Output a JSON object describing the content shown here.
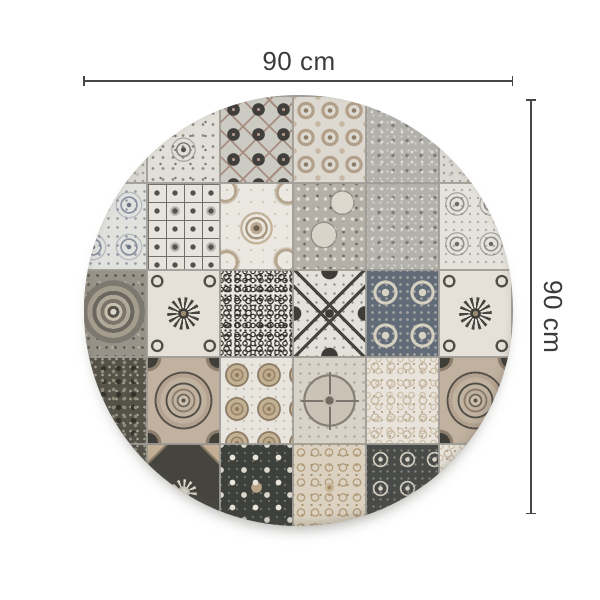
{
  "diagram": {
    "type": "product-dimension-diagram",
    "width_label": "90 cm",
    "height_label": "90 cm"
  },
  "rug": {
    "shape": "round",
    "style": "patchwork-azulejo-tiles",
    "grid": {
      "cols": 6,
      "rows": 5,
      "tile_w": 73,
      "tile_h": 87,
      "origin_x": -10,
      "origin_y": 1
    },
    "tiles": [
      {
        "row": 0,
        "col": 0,
        "pattern": "light-lace"
      },
      {
        "row": 0,
        "col": 1,
        "pattern": "snowflake-damask"
      },
      {
        "row": 0,
        "col": 2,
        "pattern": "diamond-floret"
      },
      {
        "row": 0,
        "col": 3,
        "pattern": "taupe-quatrefoil"
      },
      {
        "row": 0,
        "col": 4,
        "pattern": "grey-lace"
      },
      {
        "row": 0,
        "col": 5,
        "pattern": "light-lace"
      },
      {
        "row": 1,
        "col": 0,
        "pattern": "indigo-lace"
      },
      {
        "row": 1,
        "col": 1,
        "pattern": "geo-squares"
      },
      {
        "row": 1,
        "col": 2,
        "pattern": "baroque-medallion"
      },
      {
        "row": 1,
        "col": 3,
        "pattern": "floral-chintz"
      },
      {
        "row": 1,
        "col": 4,
        "pattern": "grey-lace"
      },
      {
        "row": 1,
        "col": 5,
        "pattern": "diamond-light"
      },
      {
        "row": 2,
        "col": 0,
        "pattern": "circle-medallion"
      },
      {
        "row": 2,
        "col": 1,
        "pattern": "sunflower-cream"
      },
      {
        "row": 2,
        "col": 2,
        "pattern": "scroll-lace"
      },
      {
        "row": 2,
        "col": 3,
        "pattern": "x-cross"
      },
      {
        "row": 2,
        "col": 4,
        "pattern": "slate-quatrefoil"
      },
      {
        "row": 2,
        "col": 5,
        "pattern": "sunflower-cream"
      },
      {
        "row": 3,
        "col": 0,
        "pattern": "dark-foliage"
      },
      {
        "row": 3,
        "col": 1,
        "pattern": "tan-cushion"
      },
      {
        "row": 3,
        "col": 2,
        "pattern": "coin-rosettes"
      },
      {
        "row": 3,
        "col": 3,
        "pattern": "petal-circle"
      },
      {
        "row": 3,
        "col": 4,
        "pattern": "light-scroll"
      },
      {
        "row": 3,
        "col": 5,
        "pattern": "tan-cushion"
      },
      {
        "row": 4,
        "col": 0,
        "pattern": "dark-foliage"
      },
      {
        "row": 4,
        "col": 1,
        "pattern": "dark-corner-flower"
      },
      {
        "row": 4,
        "col": 2,
        "pattern": "charcoal-flowers"
      },
      {
        "row": 4,
        "col": 3,
        "pattern": "beige-damask"
      },
      {
        "row": 4,
        "col": 4,
        "pattern": "charcoal-lace"
      },
      {
        "row": 4,
        "col": 5,
        "pattern": "light-scroll"
      }
    ]
  },
  "palette": {
    "background": "#ffffff",
    "dimension_line": "#474747",
    "dimension_text": "#3b3b3b",
    "grout": "#a5a49e",
    "cream": "#e8e5de",
    "light_grey": "#cbcac3",
    "mid_grey": "#8f8e88",
    "charcoal": "#3f3e3a",
    "slate_blue": "#626b78",
    "taupe": "#b3a28f",
    "mauve_brown": "#a78c80"
  }
}
